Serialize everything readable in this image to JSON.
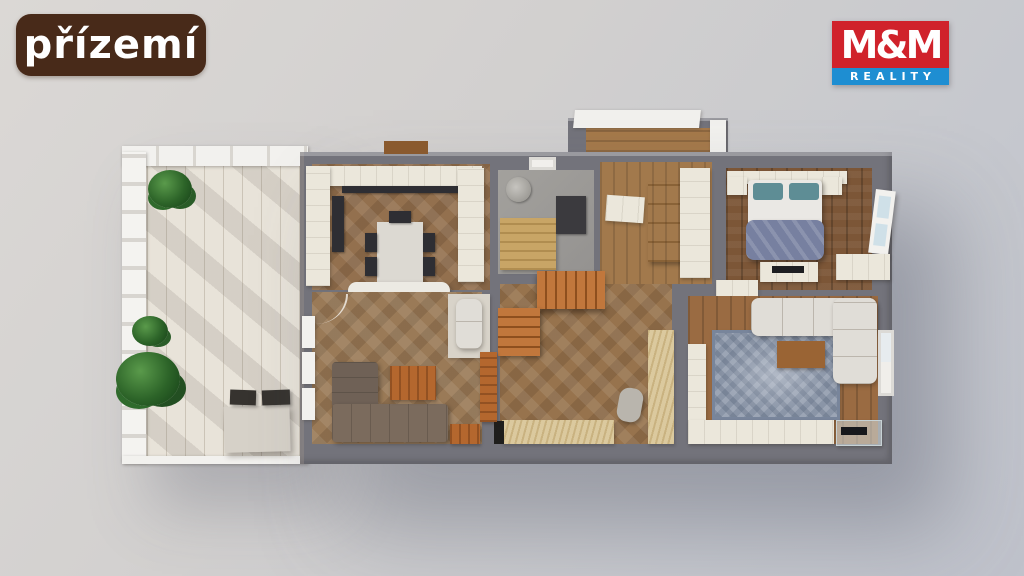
{
  "floor_label": {
    "text": "přízemí",
    "background": "#482a19",
    "color": "#ffffff"
  },
  "logo": {
    "line1": "M&M",
    "line2": "REALITY",
    "red": "#d0222b",
    "blue": "#1e8ed2",
    "color": "#ffffff"
  },
  "scene": {
    "type": "3d-floor-plan-top-view-render",
    "background_top_left": "#dbd8d5",
    "background_bottom_right": "#bfc2cb",
    "wall_color": "#73737b",
    "rooms": [
      {
        "name": "terrace",
        "floor_color": "#e8e3d9",
        "items": [
          "pergola",
          "railing",
          "plants",
          "table",
          "two-chairs"
        ]
      },
      {
        "name": "kitchen-dining",
        "floor_color": "#93704e",
        "items": [
          "white-cabinets",
          "dark-counter",
          "fridge",
          "dining-table",
          "five-chairs"
        ]
      },
      {
        "name": "bathroom",
        "floor_color": "#9b9995",
        "items": [
          "shower",
          "wood-bench",
          "dark-fixture",
          "window"
        ]
      },
      {
        "name": "entry-hall",
        "floor_color": "#a2794c",
        "items": [
          "porch-canopy",
          "wood-cabinet",
          "white-wardrobe"
        ]
      },
      {
        "name": "bedroom",
        "floor_color": "#7c5637",
        "items": [
          "double-bed-blue-duvet",
          "teal-pillows",
          "nightstands",
          "tv-dresser",
          "open-glass-door"
        ]
      },
      {
        "name": "living-room",
        "floor_color": "#9a6b42",
        "items": [
          "l-shaped-white-sofa",
          "blue-patterned-rug",
          "wood-coffee-table",
          "sideboards",
          "glass-tv-stand"
        ]
      },
      {
        "name": "hallway",
        "floor_color": "#97734d",
        "items": [
          "l-shaped-staircase",
          "plywood-partition",
          "door-leaf"
        ]
      },
      {
        "name": "den",
        "floor_color": "#9a7a57",
        "items": [
          "brown-corner-sofa",
          "wood-table",
          "white-armchair",
          "wood-desk",
          "terrace-windows"
        ]
      }
    ]
  }
}
